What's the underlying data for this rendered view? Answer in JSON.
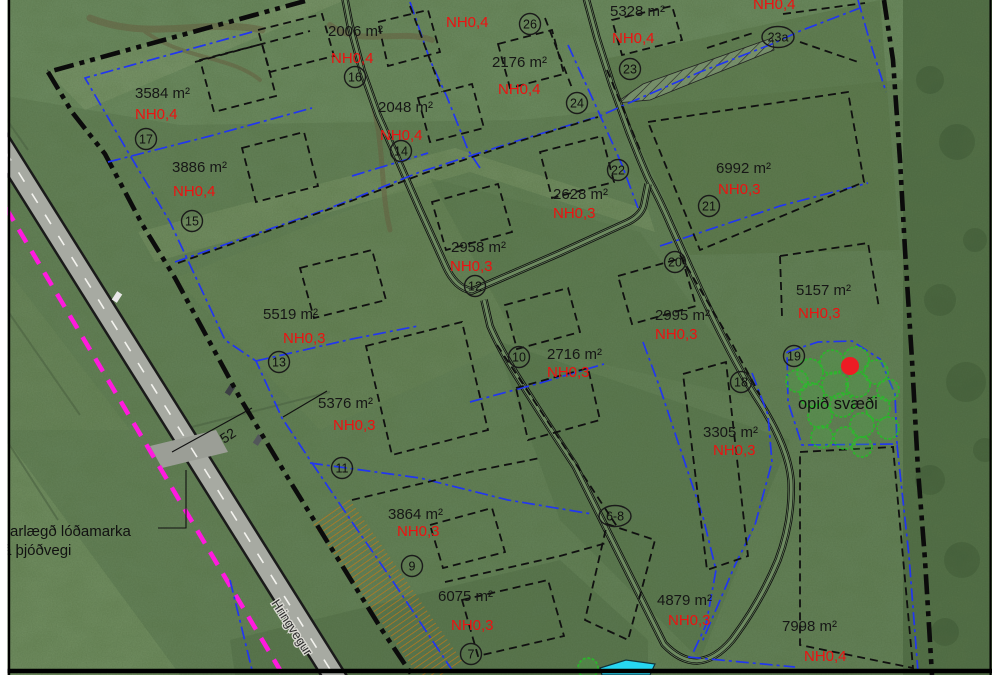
{
  "map_type": "site-plan-overlay",
  "colors": {
    "nh_red": "#ee1111",
    "parcel_blue": "#2236f0",
    "boundary_black": "#0b0b0b",
    "magenta": "#ff1ade",
    "orange_hatch": "#c07818",
    "tree_green": "#2db32d",
    "dot_red": "#ed1c24",
    "pond_cyan": "#27d7f2"
  },
  "plots": [
    {
      "area": "2006 m²",
      "ax": 328,
      "ay": 36,
      "nh": "NH0,4",
      "nx": 331,
      "ny": 63
    },
    {
      "area": "2176 m²",
      "ax": 492,
      "ay": 67,
      "nh": "NH0,4",
      "nx": 498,
      "ny": 94
    },
    {
      "area": "2048 m²",
      "ax": 378,
      "ay": 112,
      "nh": "NH0,4",
      "nx": 380,
      "ny": 140
    },
    {
      "area": "5328 m²",
      "ax": 610,
      "ay": 16,
      "nh": "NH0,4",
      "nx": 612,
      "ny": 43
    },
    {
      "area": null,
      "ax": 0,
      "ay": 0,
      "nh": "NH0,4",
      "nx": 446,
      "ny": 27
    },
    {
      "area": null,
      "ax": 0,
      "ay": 0,
      "nh": "NH0,4",
      "nx": 753,
      "ny": 9
    },
    {
      "area": "3584 m²",
      "ax": 135,
      "ay": 98,
      "nh": "NH0,4",
      "nx": 135,
      "ny": 119
    },
    {
      "area": "3886 m²",
      "ax": 172,
      "ay": 172,
      "nh": "NH0,4",
      "nx": 173,
      "ny": 196
    },
    {
      "area": "2628 m²",
      "ax": 553,
      "ay": 199,
      "nh": "NH0,3",
      "nx": 553,
      "ny": 218
    },
    {
      "area": "6992 m²",
      "ax": 716,
      "ay": 173,
      "nh": "NH0,3",
      "nx": 718,
      "ny": 194
    },
    {
      "area": "2958 m²",
      "ax": 451,
      "ay": 252,
      "nh": "NH0,3",
      "nx": 450,
      "ny": 271
    },
    {
      "area": "2995 m²",
      "ax": 655,
      "ay": 320,
      "nh": "NH0,3",
      "nx": 655,
      "ny": 339
    },
    {
      "area": "5519 m²",
      "ax": 263,
      "ay": 319,
      "nh": "NH0,3",
      "nx": 283,
      "ny": 343
    },
    {
      "area": "5157 m²",
      "ax": 796,
      "ay": 295,
      "nh": "NH0,3",
      "nx": 798,
      "ny": 318
    },
    {
      "area": "2716 m²",
      "ax": 547,
      "ay": 359,
      "nh": "NH0,3",
      "nx": 547,
      "ny": 377
    },
    {
      "area": "3305 m²",
      "ax": 703,
      "ay": 437,
      "nh": "NH0,3",
      "nx": 713,
      "ny": 455
    },
    {
      "area": "5376 m²",
      "ax": 318,
      "ay": 408,
      "nh": "NH0,3",
      "nx": 333,
      "ny": 430
    },
    {
      "area": "3864 m²",
      "ax": 388,
      "ay": 519,
      "nh": "NH0,3",
      "nx": 397,
      "ny": 536
    },
    {
      "area": "6075 m²",
      "ax": 438,
      "ay": 601,
      "nh": "NH0,3",
      "nx": 451,
      "ny": 630
    },
    {
      "area": "4879 m²",
      "ax": 657,
      "ay": 605,
      "nh": "NH0,3",
      "nx": 668,
      "ny": 625
    },
    {
      "area": "7998 m²",
      "ax": 782,
      "ay": 631,
      "nh": "NH0,4",
      "nx": 804,
      "ny": 661
    }
  ],
  "plot_numbers": [
    {
      "t": "16",
      "x": 355,
      "y": 77
    },
    {
      "t": "26",
      "x": 530,
      "y": 24
    },
    {
      "t": "23a",
      "x": 778,
      "y": 37,
      "wide": true
    },
    {
      "t": "23",
      "x": 630,
      "y": 69
    },
    {
      "t": "24",
      "x": 577,
      "y": 103
    },
    {
      "t": "17",
      "x": 146,
      "y": 139
    },
    {
      "t": "14",
      "x": 401,
      "y": 151
    },
    {
      "t": "22",
      "x": 618,
      "y": 170
    },
    {
      "t": "15",
      "x": 192,
      "y": 221
    },
    {
      "t": "21",
      "x": 709,
      "y": 206
    },
    {
      "t": "20",
      "x": 675,
      "y": 262
    },
    {
      "t": "12",
      "x": 475,
      "y": 286
    },
    {
      "t": "13",
      "x": 279,
      "y": 362
    },
    {
      "t": "10",
      "x": 519,
      "y": 357
    },
    {
      "t": "19",
      "x": 794,
      "y": 356
    },
    {
      "t": "18",
      "x": 741,
      "y": 382
    },
    {
      "t": "11",
      "x": 342,
      "y": 468
    },
    {
      "t": "9",
      "x": 412,
      "y": 566
    },
    {
      "t": "7",
      "x": 471,
      "y": 654
    },
    {
      "t": "6-8",
      "x": 615,
      "y": 516,
      "wide": true
    }
  ],
  "notes": {
    "open_area": "opið svæði",
    "distance_line1": "arlægð lóðamarka",
    "distance_line2": "rá þjóðvegi",
    "distance_value": "52",
    "road_name": "Hringvegur"
  }
}
